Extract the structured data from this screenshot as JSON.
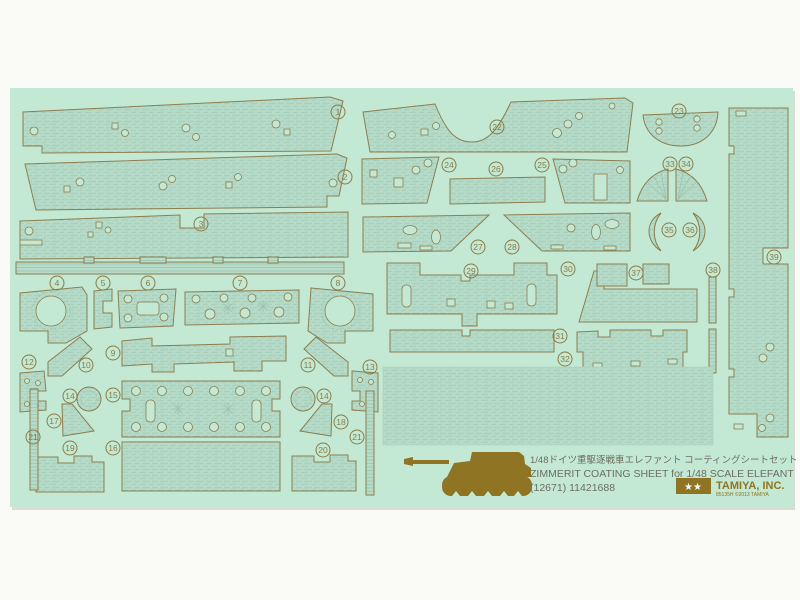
{
  "product": {
    "title_jp": "1/48ドイツ重駆逐戦車エレファント コーティングシートセット",
    "title_en": "ZIMMERIT COATING SHEET for 1/48 SCALE ELEFANT",
    "item_code": "(12671) 11421688",
    "brand": "TAMIYA, INC.",
    "brand_small": "85135H ©2013 TAMIYA",
    "logo_stars": "★★",
    "tank_icon": "elefant-tank-silhouette"
  },
  "colors": {
    "page_background": "#fafaf6",
    "sheet_mint": "#c3e8d4",
    "piece_fill": "#b6dcc9",
    "texture_line": "#9ec4b2",
    "outline_olive": "#8b7e4e",
    "print_gold": "#8f7423",
    "text_gray": "#6e6e60"
  },
  "part_labels": [
    {
      "n": "1",
      "x": 338,
      "y": 112
    },
    {
      "n": "2",
      "x": 345,
      "y": 177
    },
    {
      "n": "3",
      "x": 201,
      "y": 224
    },
    {
      "n": "4",
      "x": 57,
      "y": 283
    },
    {
      "n": "5",
      "x": 103,
      "y": 283
    },
    {
      "n": "6",
      "x": 148,
      "y": 283
    },
    {
      "n": "7",
      "x": 240,
      "y": 283
    },
    {
      "n": "8",
      "x": 338,
      "y": 283
    },
    {
      "n": "9",
      "x": 113,
      "y": 353
    },
    {
      "n": "10",
      "x": 86,
      "y": 365
    },
    {
      "n": "11",
      "x": 308,
      "y": 365
    },
    {
      "n": "12",
      "x": 29,
      "y": 362
    },
    {
      "n": "13",
      "x": 370,
      "y": 367
    },
    {
      "n": "14",
      "x": 70,
      "y": 396
    },
    {
      "n": "15",
      "x": 113,
      "y": 395
    },
    {
      "n": "14",
      "x": 324,
      "y": 396
    },
    {
      "n": "17",
      "x": 54,
      "y": 421
    },
    {
      "n": "18",
      "x": 341,
      "y": 422
    },
    {
      "n": "21",
      "x": 33,
      "y": 437
    },
    {
      "n": "21",
      "x": 357,
      "y": 437
    },
    {
      "n": "19",
      "x": 70,
      "y": 448
    },
    {
      "n": "16",
      "x": 113,
      "y": 448
    },
    {
      "n": "20",
      "x": 323,
      "y": 450
    },
    {
      "n": "22",
      "x": 497,
      "y": 127
    },
    {
      "n": "23",
      "x": 679,
      "y": 111
    },
    {
      "n": "24",
      "x": 449,
      "y": 165
    },
    {
      "n": "25",
      "x": 542,
      "y": 165
    },
    {
      "n": "26",
      "x": 496,
      "y": 169
    },
    {
      "n": "27",
      "x": 478,
      "y": 247
    },
    {
      "n": "28",
      "x": 512,
      "y": 247
    },
    {
      "n": "29",
      "x": 471,
      "y": 271
    },
    {
      "n": "30",
      "x": 568,
      "y": 269
    },
    {
      "n": "31",
      "x": 560,
      "y": 336
    },
    {
      "n": "32",
      "x": 565,
      "y": 359
    },
    {
      "n": "33",
      "x": 670,
      "y": 164
    },
    {
      "n": "34",
      "x": 686,
      "y": 164
    },
    {
      "n": "35",
      "x": 669,
      "y": 230
    },
    {
      "n": "36",
      "x": 690,
      "y": 230
    },
    {
      "n": "37",
      "x": 636,
      "y": 273
    },
    {
      "n": "38",
      "x": 713,
      "y": 270
    },
    {
      "n": "39",
      "x": 774,
      "y": 257
    }
  ]
}
